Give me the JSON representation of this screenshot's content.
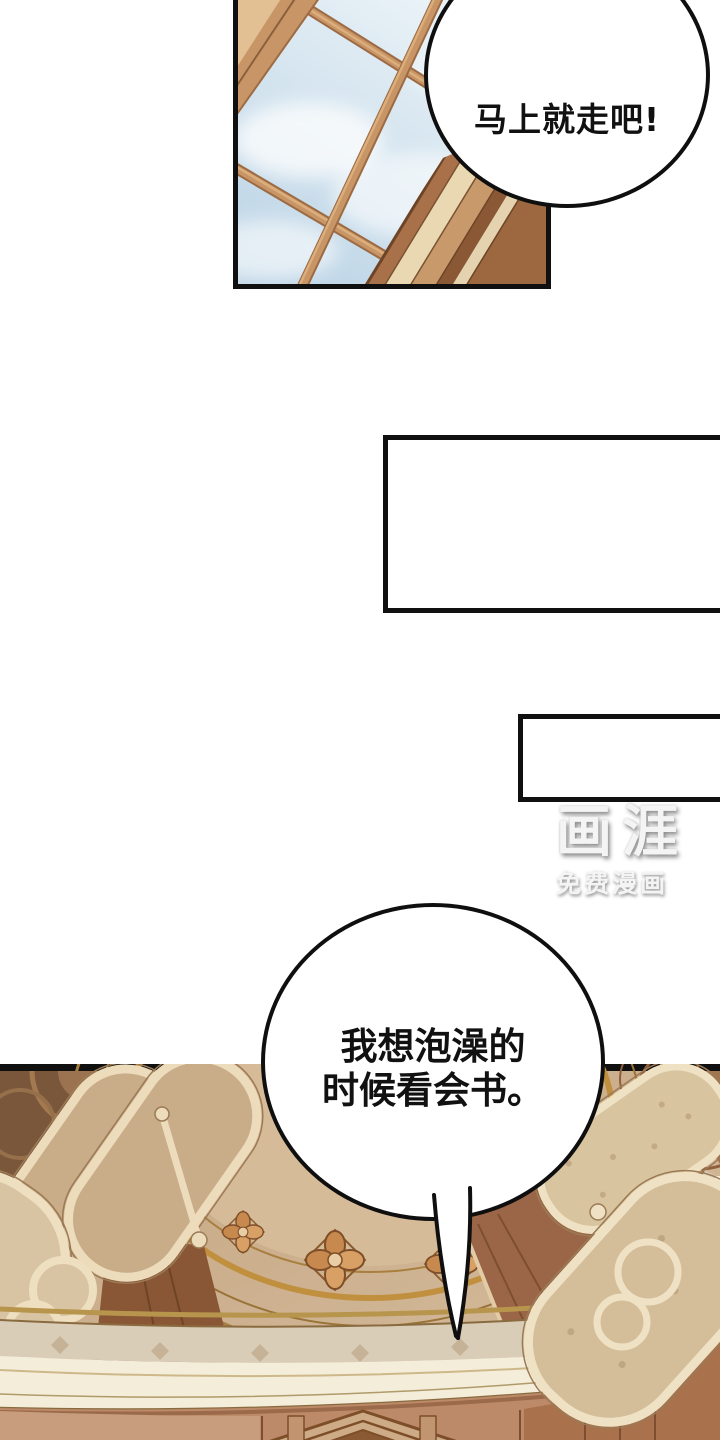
{
  "bubbles": {
    "top": {
      "text": "马上就走吧!"
    },
    "bottom": {
      "line1": "我想泡澡的",
      "line2": "时候看会书。"
    }
  },
  "watermark": {
    "logo": "画涯",
    "subtitle": "免费漫画"
  },
  "colors": {
    "page_background": "#ffffff",
    "panel_border": "#101010",
    "bubble_fill": "#ffffff",
    "bubble_border": "#0f0f0f",
    "text": "#111111",
    "watermark": "#f4f4f4",
    "sky_blue": "#cde0ed",
    "window_wood": "#c79566",
    "ceiling_beige": "#cdb190",
    "ceiling_cream": "#ecdcbc",
    "beam_brown": "#9b6647",
    "cornice_cream": "#f4edda",
    "wall_salmon": "#bc8a68",
    "gold_trim": "#b8954d"
  }
}
